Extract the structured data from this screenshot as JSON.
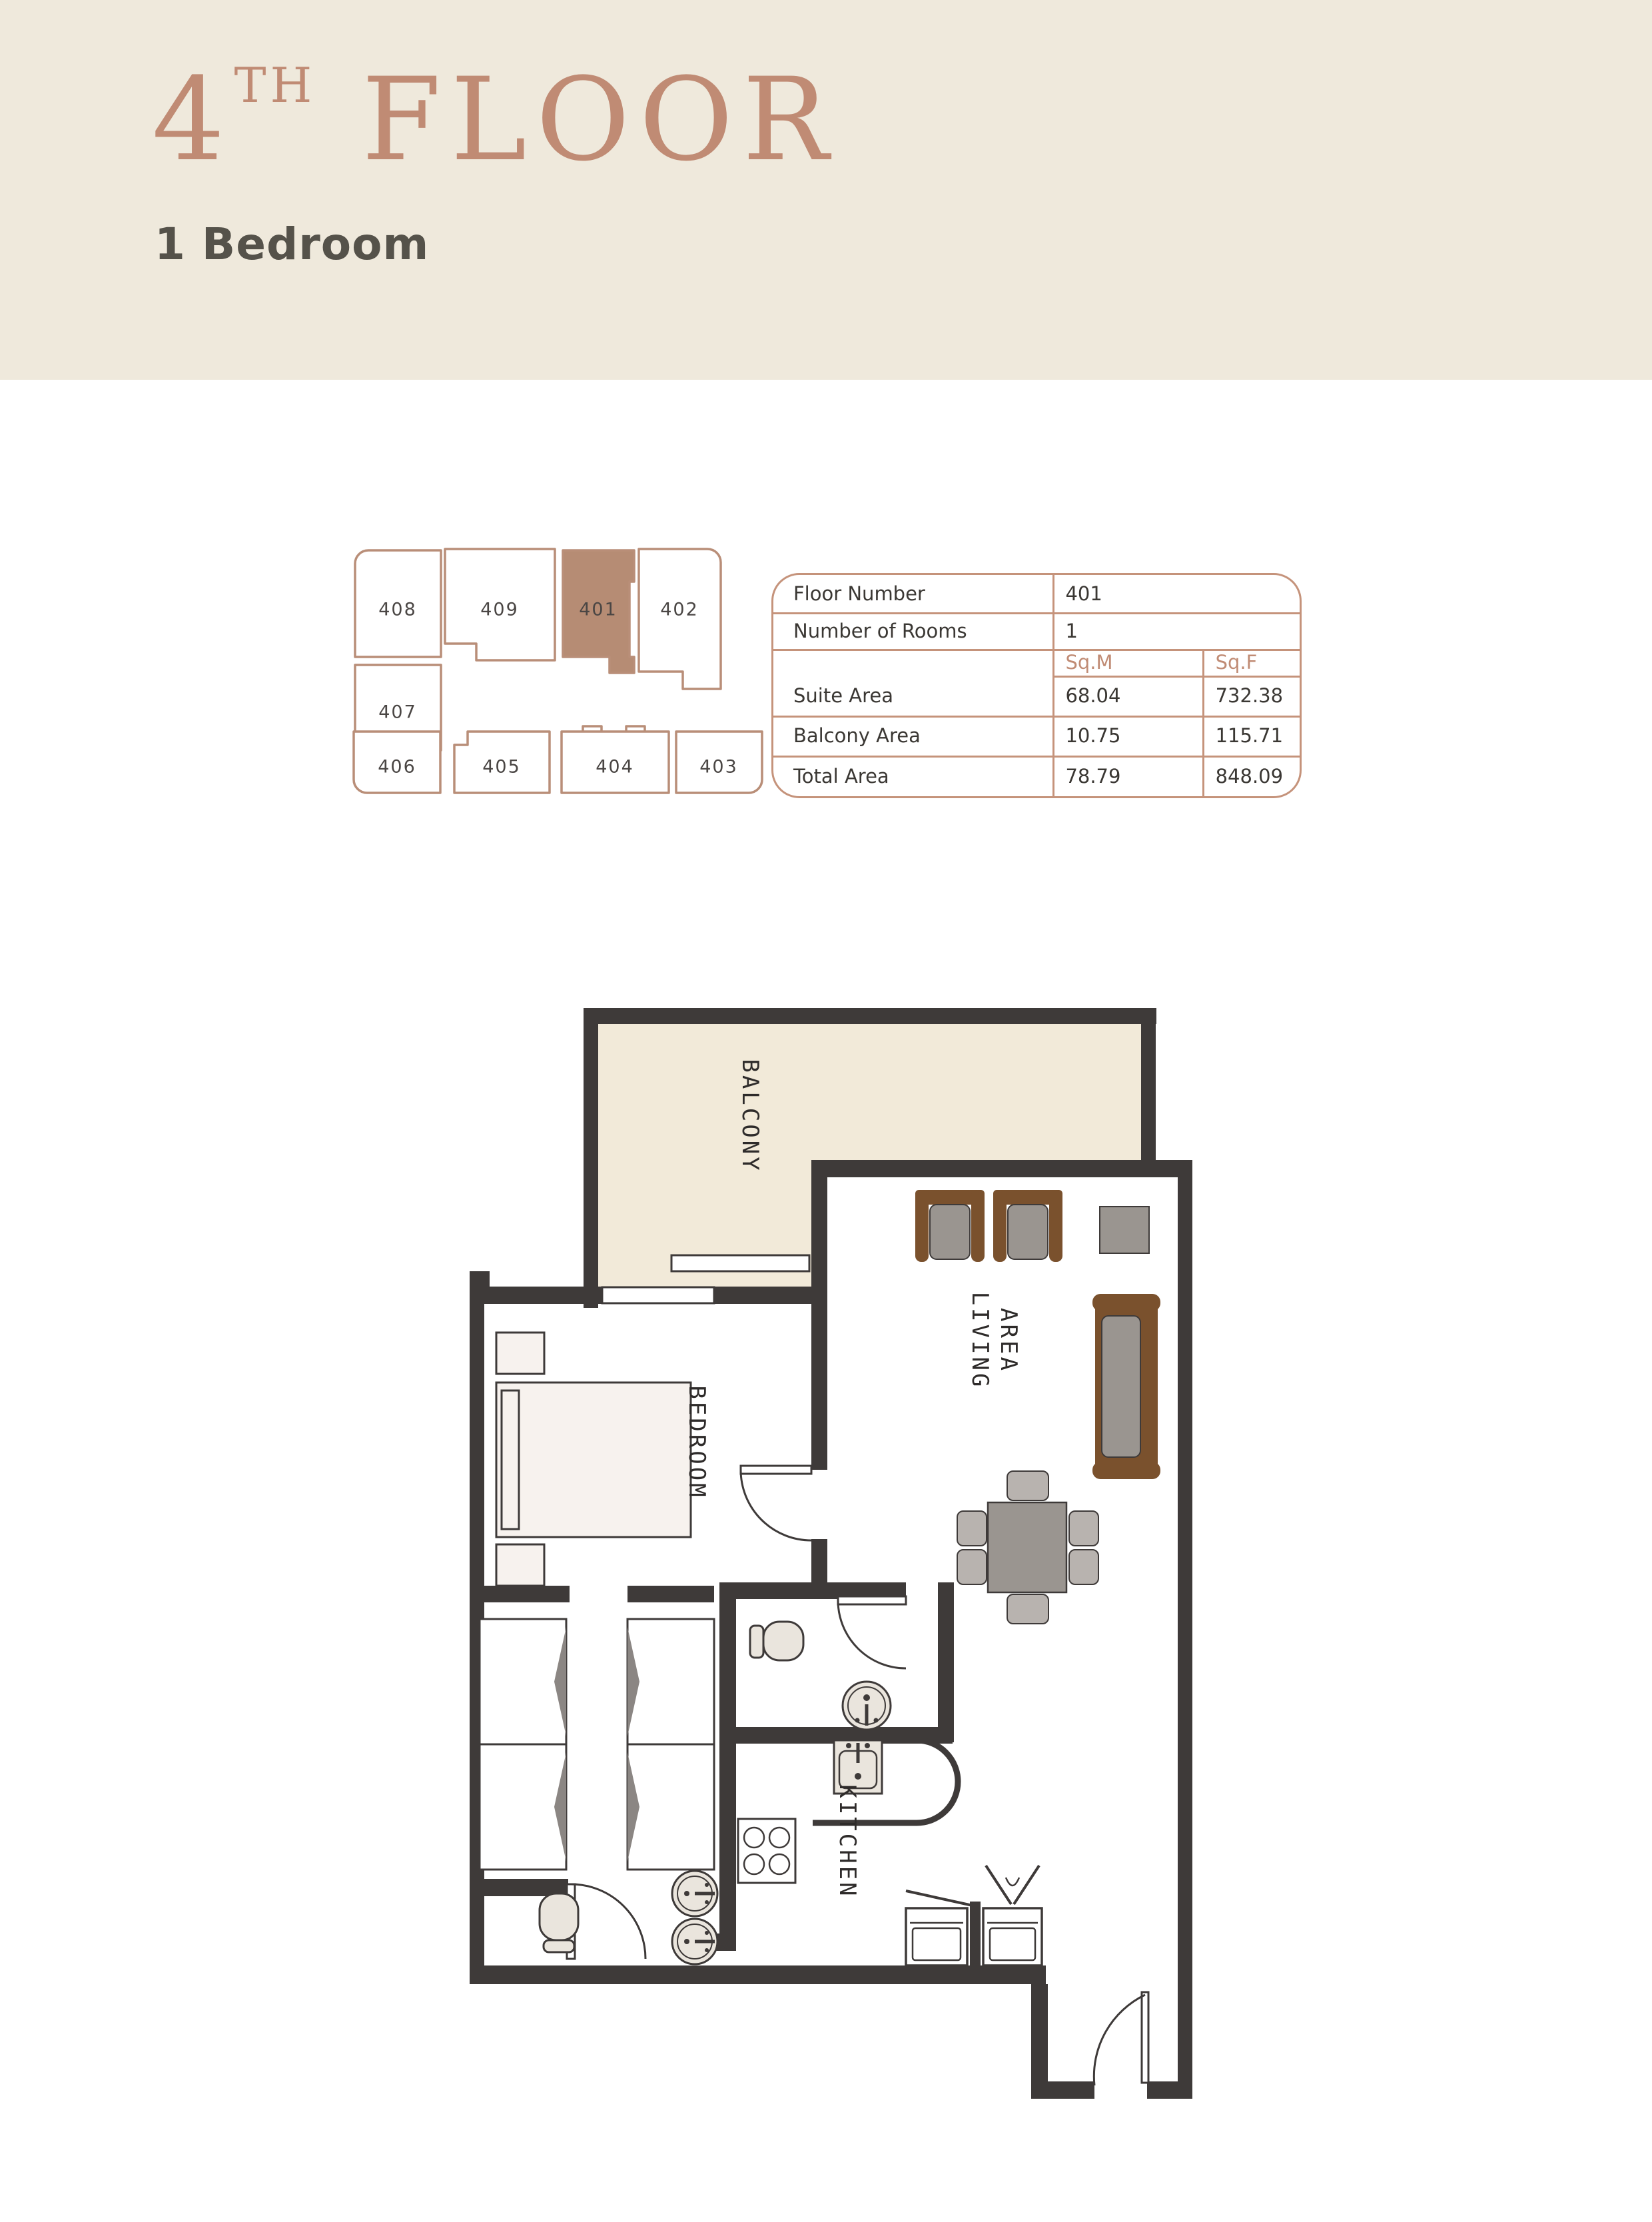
{
  "header": {
    "title_number": "4",
    "title_sup": "TH",
    "title_word": "FLOOR",
    "subtitle": "1 Bedroom"
  },
  "keyplan": {
    "line_color": "#b98e78",
    "highlight_color": "#b68c74",
    "highlighted_unit": "401",
    "units": [
      {
        "label": "408"
      },
      {
        "label": "409"
      },
      {
        "label": "401"
      },
      {
        "label": "402"
      },
      {
        "label": "407"
      },
      {
        "label": "406"
      },
      {
        "label": "405"
      },
      {
        "label": "404"
      },
      {
        "label": "403"
      }
    ]
  },
  "info_table": {
    "floor_number_label": "Floor Number",
    "floor_number": "401",
    "rooms_label": "Number of Rooms",
    "rooms": "1",
    "sqm_header": "Sq.M",
    "sqf_header": "Sq.F",
    "suite_label": "Suite Area",
    "suite_sqm": "68.04",
    "suite_sqf": "732.38",
    "balcony_label": "Balcony Area",
    "balcony_sqm": "10.75",
    "balcony_sqf": "115.71",
    "total_label": "Total Area",
    "total_sqm": "78.79",
    "total_sqf": "848.09"
  },
  "floor_plan": {
    "wall_color": "#3e3a39",
    "balcony_fill": "#f2ead9",
    "furniture_brown": "#7a512d",
    "furniture_gray": "#9a9590",
    "fixture_fill": "#eae5dd",
    "labels": {
      "balcony": "BALCONY",
      "bedroom": "BEDROOM",
      "living_line1": "LIVING",
      "living_line2": "AREA",
      "kitchen": "KITCHEN"
    }
  }
}
